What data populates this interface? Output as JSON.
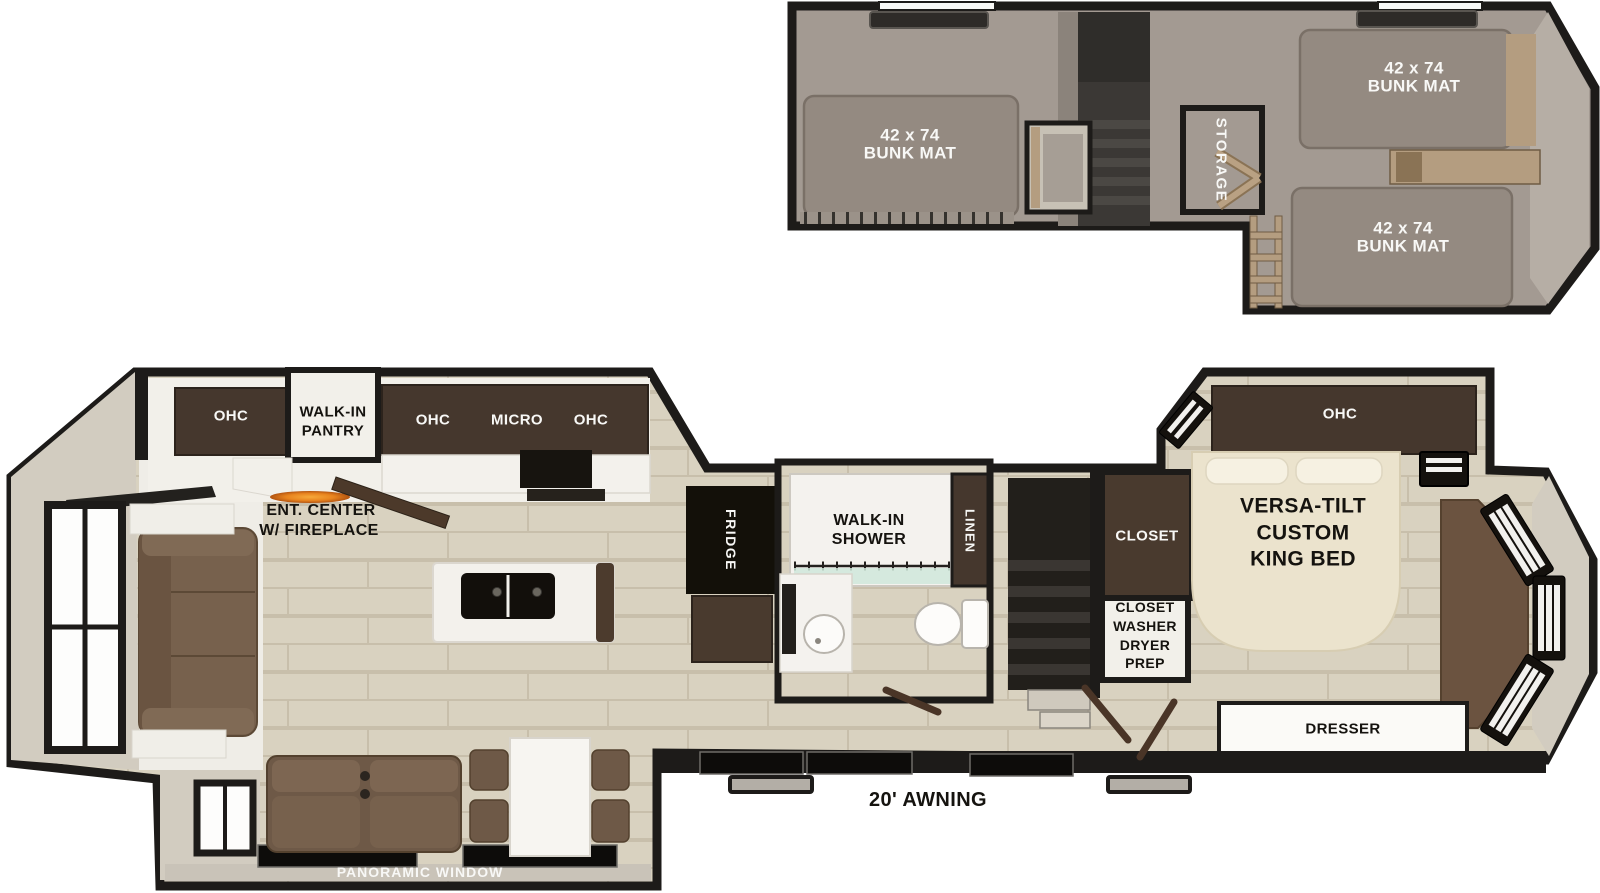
{
  "plan_type": "RV floor plan with loft",
  "colors": {
    "wall": "#1d1b19",
    "wood_floor": "#d9d2c0",
    "loft_floor": "#a39a92",
    "bunk_mat": "#948a81",
    "cabinet_dark": "#45372d",
    "sofa_brown": "#77614d",
    "tan_wood": "#b49d80",
    "flame_accent": "#e8831e",
    "shower_glass": "#cfe7db",
    "white_fixture": "#f4f2ee"
  },
  "loft": {
    "bunk_left": {
      "size": "42 x 74",
      "label": "BUNK MAT"
    },
    "bunk_top_right": {
      "size": "42 x 74",
      "label": "BUNK MAT"
    },
    "bunk_bottom_right": {
      "size": "42 x 74",
      "label": "BUNK MAT"
    },
    "storage": "STORAGE"
  },
  "main": {
    "rear_ohc": "OHC",
    "pantry": {
      "line1": "WALK-IN",
      "line2": "PANTRY"
    },
    "kitchen": {
      "ohc_left": "OHC",
      "micro": "MICRO",
      "ohc_right": "OHC"
    },
    "ent_center": {
      "line1": "ENT. CENTER",
      "line2": "W/ FIREPLACE"
    },
    "fridge": "FRIDGE",
    "bathroom": {
      "shower_line1": "WALK-IN",
      "shower_line2": "SHOWER",
      "linen": "LINEN"
    },
    "bedroom": {
      "closet": "CLOSET",
      "wd_line1": "CLOSET",
      "wd_line2": "WASHER",
      "wd_line3": "DRYER",
      "wd_line4": "PREP",
      "ohc": "OHC",
      "bed_line1": "VERSA-TILT",
      "bed_line2": "CUSTOM",
      "bed_line3": "KING BED",
      "dresser": "DRESSER"
    },
    "awning": "20' AWNING",
    "panoramic": "PANORAMIC WINDOW"
  }
}
